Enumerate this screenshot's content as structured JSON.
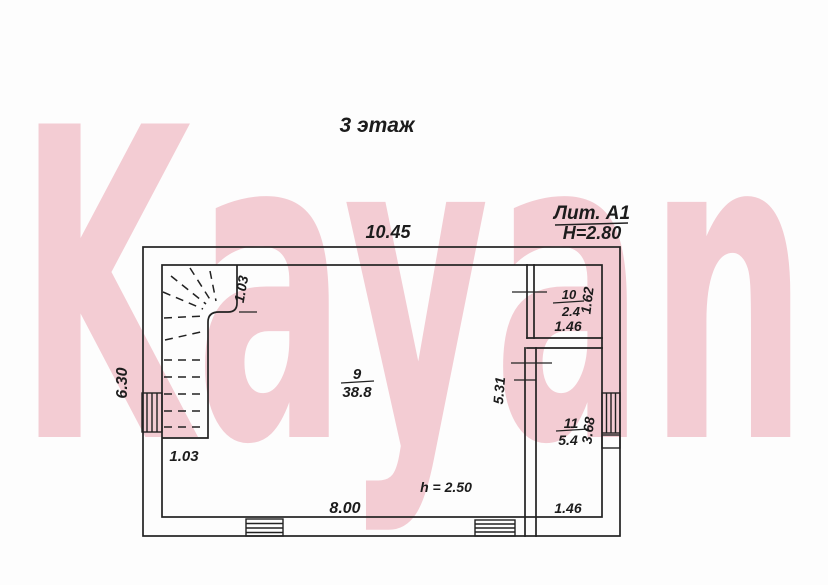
{
  "watermark": {
    "text": "Kayan",
    "color": "#f3ccd3"
  },
  "title": "3 этаж",
  "header": {
    "liter": "Лит. А1",
    "ceiling_height": "Н=2.80"
  },
  "plan": {
    "dims": {
      "top_width": "10.45",
      "left_height": "6.30",
      "stair_upper": "1.03",
      "stair_lower": "1.03",
      "interior_wall": "5.31",
      "hall_width": "8.00",
      "room_height_note": "h = 2.50"
    },
    "rooms": [
      {
        "number": "9",
        "area": "38.8"
      },
      {
        "number": "10",
        "area": "2.4",
        "width": "1.46",
        "height": "1.62"
      },
      {
        "number": "11",
        "area": "5.4",
        "width": "1.46",
        "height": "3.68"
      }
    ]
  }
}
